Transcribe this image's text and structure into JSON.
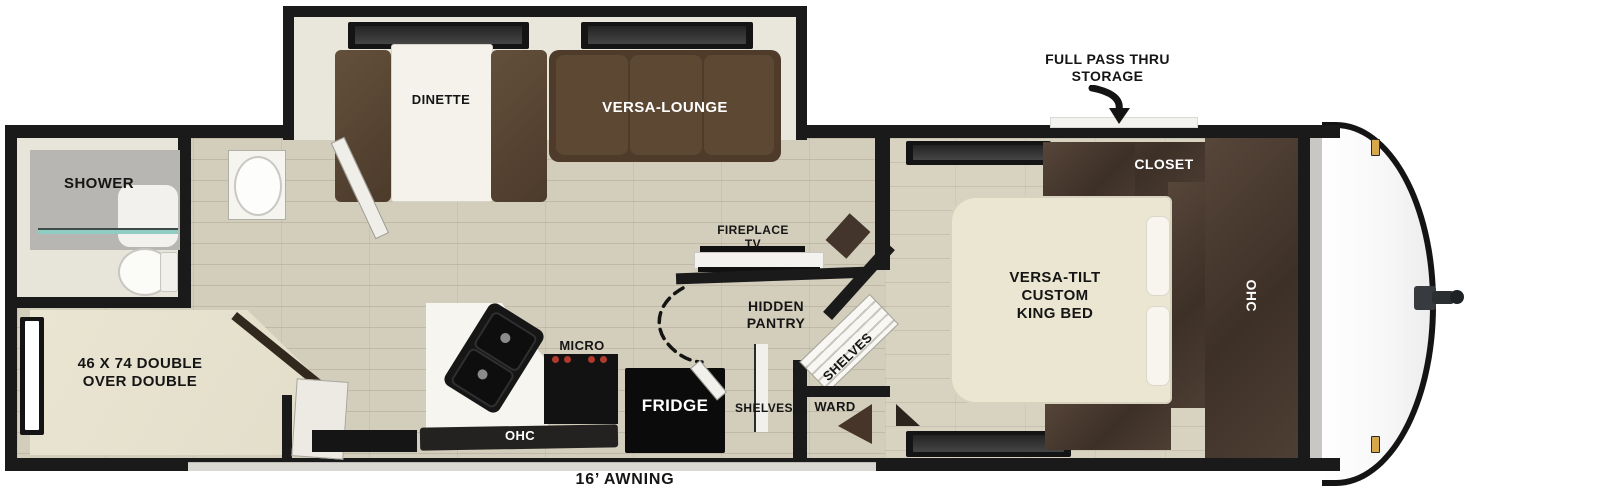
{
  "colors": {
    "wall": "#1a1a1a",
    "wood_floor": "#d3cdbb",
    "slide_room_floor": "#e9e6db",
    "sofa_brown": "#55412e",
    "cabinet_brown": "#46392c",
    "bed_cream": "#ebe6d1",
    "counter_white": "#f6f5f0",
    "appliance_black": "#0d0d0d",
    "burner_red": "#b03a2e",
    "shower_glass_teal": "#8fccc2",
    "marker_light_gold": "#d7a74b",
    "awning_gray": "#d8d7d2"
  },
  "slideout": {
    "dinette_label": "DINETTE",
    "lounge_label": "VERSA-LOUNGE"
  },
  "rear": {
    "shower_label": "SHOWER",
    "bunk_label": [
      "46 X 74 DOUBLE",
      "OVER DOUBLE"
    ]
  },
  "kitchen": {
    "micro_label": "MICRO",
    "fridge_label": "FRIDGE",
    "ohc_label": "OHC"
  },
  "living": {
    "fireplace_label": [
      "FIREPLACE",
      "TV"
    ],
    "pantry_label": [
      "HIDDEN",
      "PANTRY"
    ]
  },
  "storage": {
    "shelves_corner_label": "SHELVES",
    "shelves_hall_label": "SHELVES",
    "ward_label": "WARD"
  },
  "bedroom": {
    "closet_label": "CLOSET",
    "bed_label": [
      "VERSA-TILT",
      "CUSTOM",
      "KING BED"
    ],
    "ohc_label": "OHC"
  },
  "callouts": {
    "pass_thru": [
      "FULL PASS THRU",
      "STORAGE"
    ],
    "awning": "16’ AWNING"
  }
}
